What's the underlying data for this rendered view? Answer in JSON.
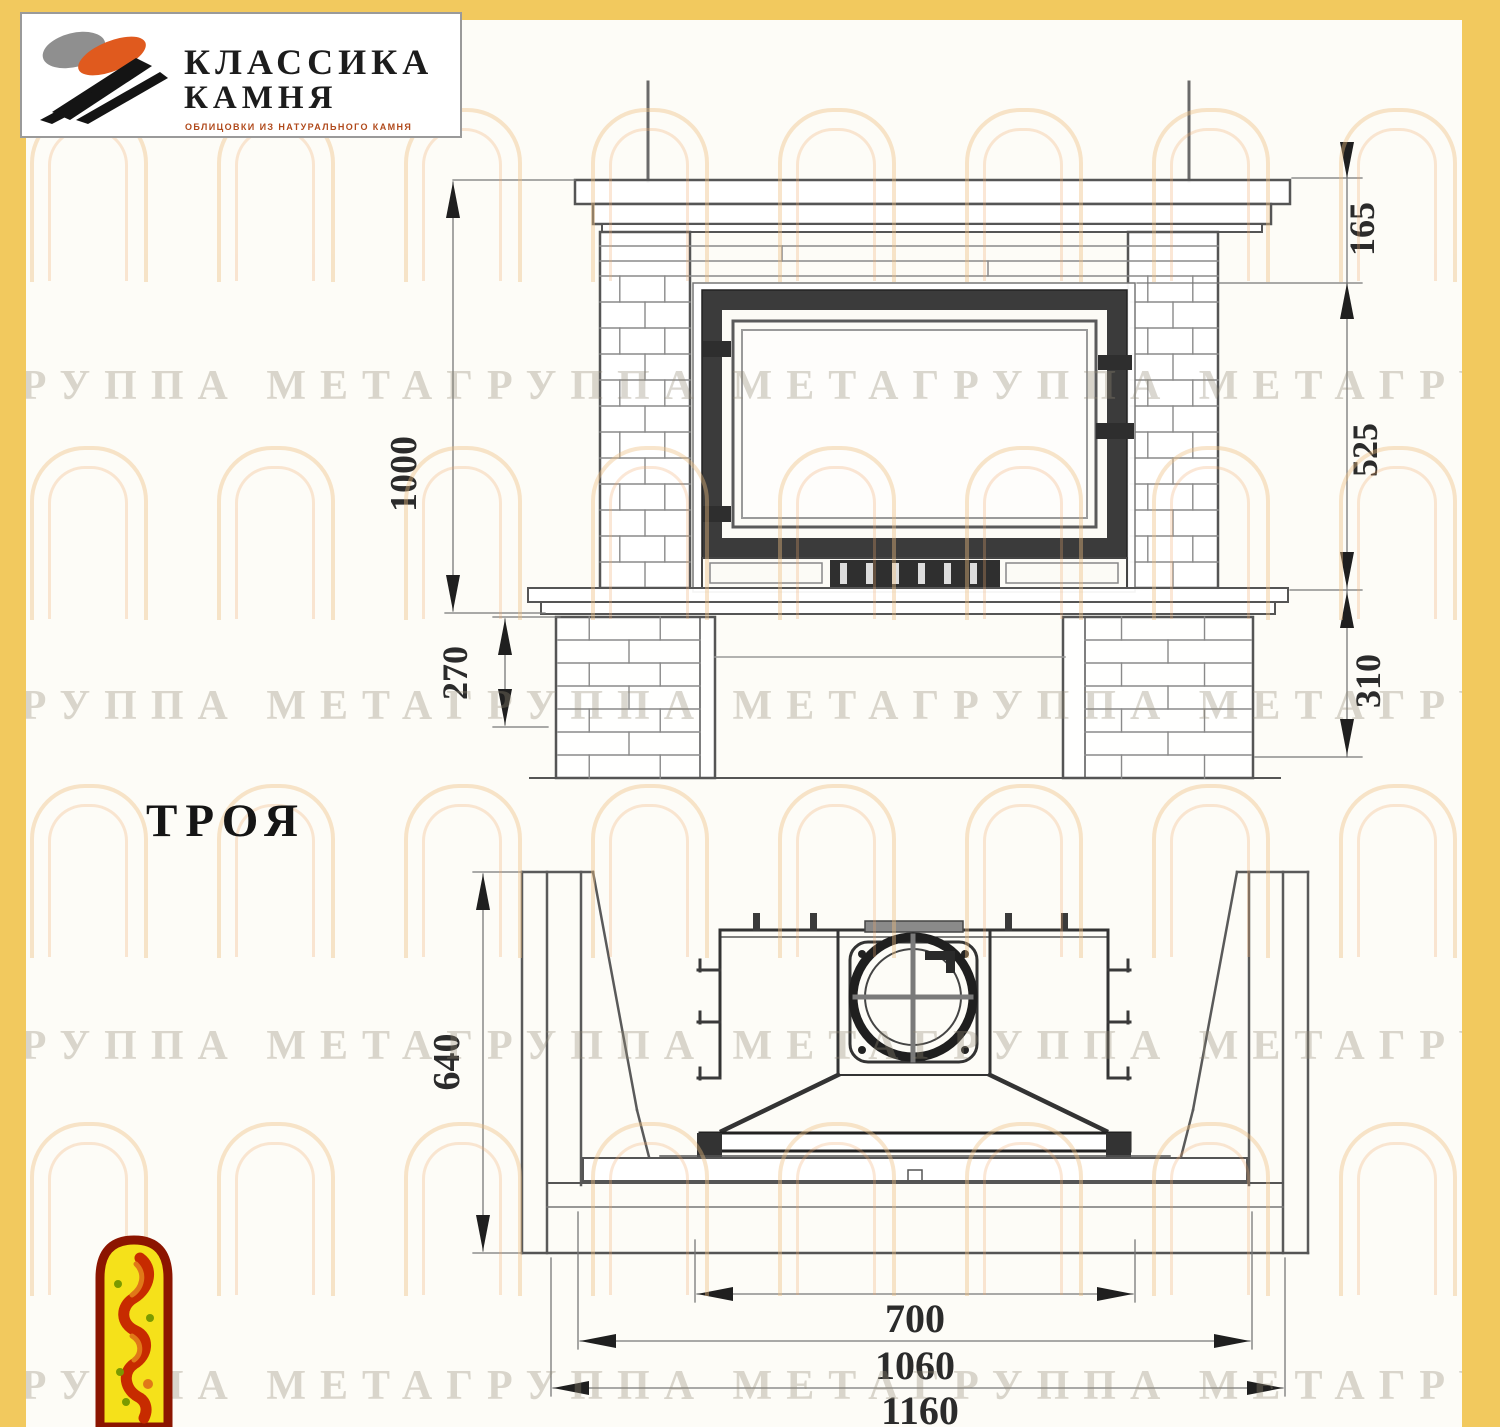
{
  "brand": {
    "name_line1": "КЛАССИКА",
    "name_line2": "КАМНЯ",
    "tagline": "ОБЛИЦОВКИ ИЗ НАТУРАЛЬНОГО КАМНЯ"
  },
  "product": {
    "model_name": "ТРОЯ"
  },
  "watermark": {
    "row_text": "ГРУППА МЕТАГРУППА МЕТАГРУППА МЕТАГРУППА МЕТА"
  },
  "front_view": {
    "dimensions": {
      "overall_height": "1000",
      "mantel_to_opening": "165",
      "opening_height": "525",
      "pedestal_height": "270",
      "base_height": "310"
    }
  },
  "plan_view": {
    "dimensions": {
      "depth": "640",
      "opening_width": "700",
      "inner_width": "1060",
      "overall_width": "1160"
    }
  },
  "colors": {
    "frame_yellow": "#f2c95e",
    "line_gray": "#555555",
    "firebox_dark": "#3b3b3b",
    "logo_orange": "#e05a1e",
    "emblem_red": "#8c1500",
    "emblem_yellow": "#f5e11a"
  }
}
